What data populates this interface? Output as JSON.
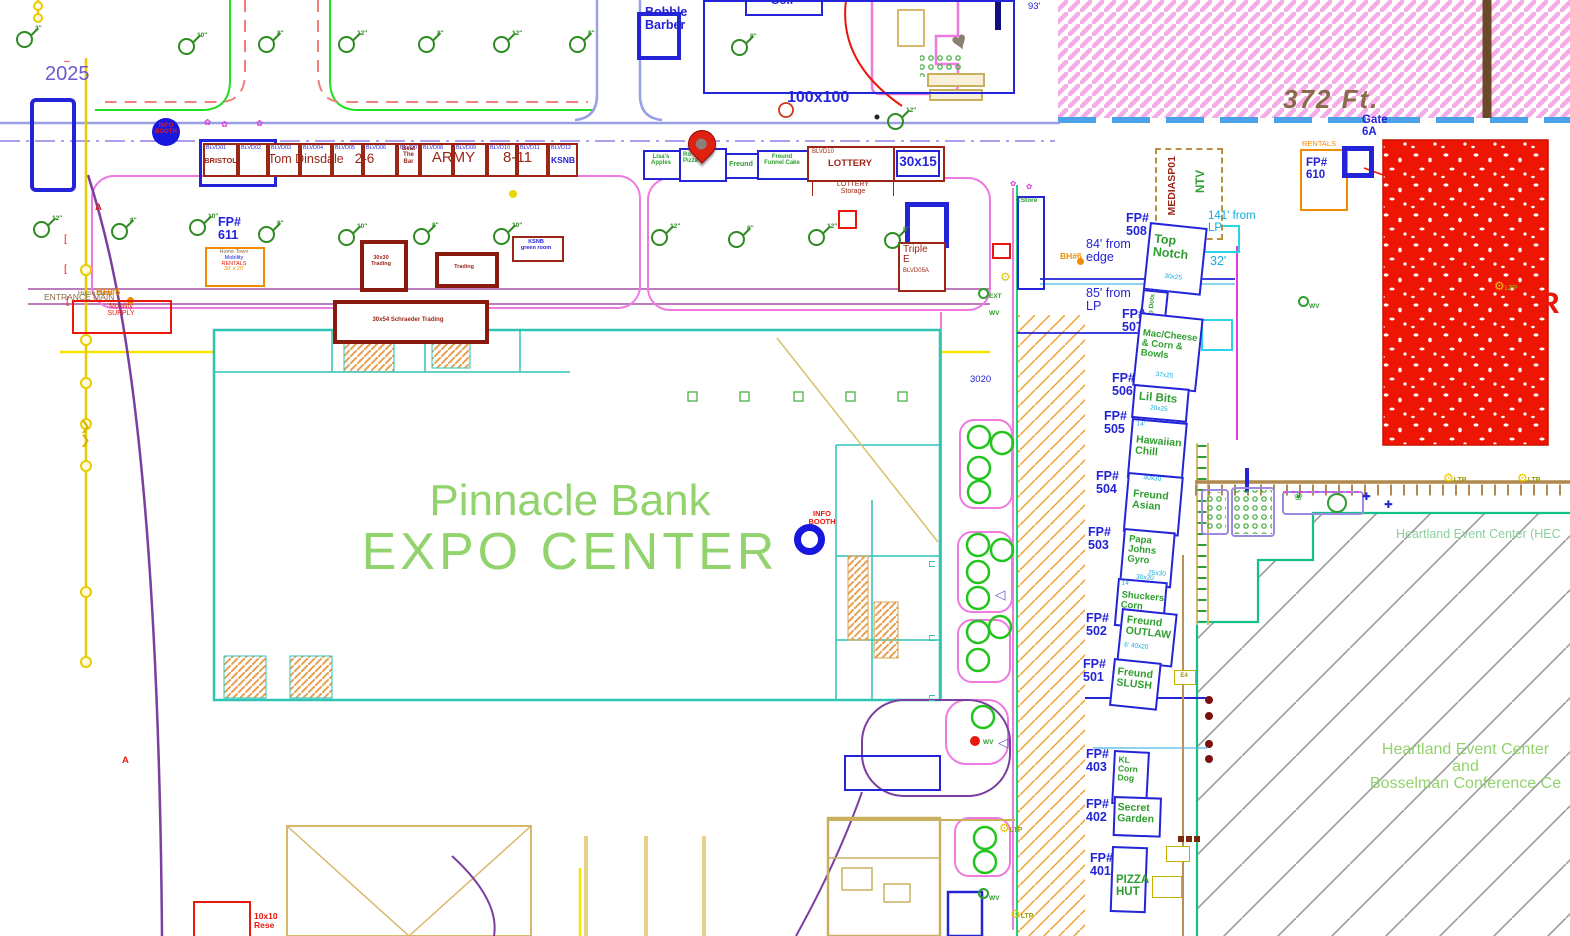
{
  "colors": {
    "cad_blue": "#2323d8",
    "cad_green": "#2e9e2e",
    "cad_cyan": "#12aae0",
    "cad_red": "#e8180c",
    "dark_red": "#9c2616",
    "orange": "#f08c00",
    "magenta": "#e33ad8",
    "expo_green": "#92d36e",
    "teal": "#2ec4b6",
    "yellow": "#f5e400",
    "pink_hatch": "#f6aae6",
    "gray_hatch": "#9a9a9a",
    "spring_green": "#19d57c",
    "tan": "#c8a860",
    "red_block": "#ee1505"
  },
  "year": "2025",
  "expo": {
    "l1": "Pinnacle Bank",
    "l2": "EXPO CENTER"
  },
  "blvd": {
    "ids": [
      "BLVD01",
      "BLVD02",
      "BLVD03",
      "BLVD04",
      "BLVD05",
      "BLVD06",
      "BLVD07",
      "BLVD08",
      "BLVD09",
      "BLVD10",
      "BLVD11",
      "BLVD12"
    ],
    "bristol": "BRISTOL",
    "tom": "Tom Dinsdale",
    "two6": "2-6",
    "beat": {
      "l1": "Beat",
      "l2": "The",
      "l3": "Bar"
    },
    "army": "ARMY",
    "e811": "8-11",
    "ksnb": "KSNB"
  },
  "mid": {
    "lisas": {
      "l1": "Lisa's",
      "l2": "Apples"
    },
    "pizza": {
      "l1": "Ro",
      "l2": "Pizza"
    },
    "freund": "Freund",
    "funnel": {
      "l1": "Freund",
      "l2": "Funnel Cake"
    },
    "blvd10": "BLVD10",
    "lottery": "LOTTERY",
    "size": "30x15",
    "storage": {
      "l1": "LOTTERY",
      "l2": "Storage"
    }
  },
  "fp": "FP#",
  "vendors": {
    "v508": {
      "num": "508",
      "l1": "Top",
      "l2": "Notch",
      "size": "30x25"
    },
    "dip": {
      "name": "Dip Dots"
    },
    "v507": {
      "num": "507",
      "l1": "Mac/Cheese",
      "l2": "& Corn &",
      "l3": "Bowls",
      "size": "37x25"
    },
    "v506": {
      "num": "506",
      "name": "Lil Bits",
      "size": "20x25"
    },
    "v505": {
      "num": "505",
      "l1": "Hawaiian",
      "l2": "Chill",
      "note": "14'"
    },
    "v504": {
      "num": "504",
      "l1": "Freund",
      "l2": "Asian",
      "size": "40x30"
    },
    "v503": {
      "num": "503",
      "l1": "Papa",
      "l2": "Johns",
      "l3": "Gyro",
      "size": "25x30"
    },
    "shuckers": {
      "l1": "Shuckers",
      "l2": "Corn",
      "size": "30x20",
      "note": "14'"
    },
    "v502": {
      "num": "502",
      "l1": "Freund",
      "l2": "OUTLAW",
      "size": "40x20",
      "note": "6'"
    },
    "v501": {
      "num": "501",
      "l1": "Freund",
      "l2": "SLUSH"
    },
    "v403": {
      "num": "403",
      "l1": "KL",
      "l2": "Corn",
      "l3": "Dog"
    },
    "v402": {
      "num": "402",
      "l1": "Secret",
      "l2": "Garden"
    },
    "v401": {
      "num": "401",
      "l1": "PIZZA",
      "l2": "HUT"
    },
    "v610": {
      "num": "610",
      "tag": "RENTALS"
    },
    "v611": {
      "num": "611"
    }
  },
  "media": {
    "l1": "NTV",
    "l2": "MEDIASP01"
  },
  "dist": {
    "ft372": "372 Ft.",
    "gate1": "Gate",
    "gate2": "6A",
    "d93": "93'",
    "d141a": "141' from",
    "d141b": "LP",
    "d32": "32'",
    "d84a": "84' from",
    "d84b": "edge",
    "d85a": "85' from",
    "d85b": "LP",
    "n3020": "3020"
  },
  "left": {
    "bh5": "BH#5",
    "bh6": "BH#6",
    "entrance": "ENTRANCE MAIN",
    "marker": "A",
    "rentals": {
      "l1": "Home Town",
      "l2": "Mobility",
      "l3": "RENTALS",
      "l4": "30' x 20'"
    },
    "supply": {
      "l0": "Home Town",
      "l1": "Mobility",
      "l2": "SUPPLY"
    },
    "trade1": {
      "l1": "30x30",
      "l2": "Trading"
    },
    "trade2": "Trading",
    "trade3": "30x54  Schraeder Trading",
    "ksnb": {
      "l1": "KSNB",
      "l2": "green room"
    },
    "triple": {
      "l1": "Triple",
      "l2": "E",
      "l3": "BLVD05A"
    },
    "res": {
      "l1": "10x10",
      "l2": "Rese"
    }
  },
  "top": {
    "bobble": {
      "l1": "Bobble",
      "l2": "Barber"
    },
    "golf": "Golf",
    "size100": "100x100"
  },
  "hec": {
    "small": "Heartland Event Center (HEC",
    "b1": "Heartland Event Center",
    "b2": "and",
    "b3": "Bosselman Conference Ce",
    "r": "R"
  },
  "misc": {
    "info1": "INFO",
    "info2": "BOOTH",
    "cstore": "CStore"
  },
  "sym": {
    "ltp": "LTP",
    "wv": "WV",
    "ext": "EXT",
    "e4": "E4"
  },
  "trees": {
    "s3": "3\"",
    "s8": "8\"",
    "s10": "10\"",
    "s12": "12\""
  }
}
